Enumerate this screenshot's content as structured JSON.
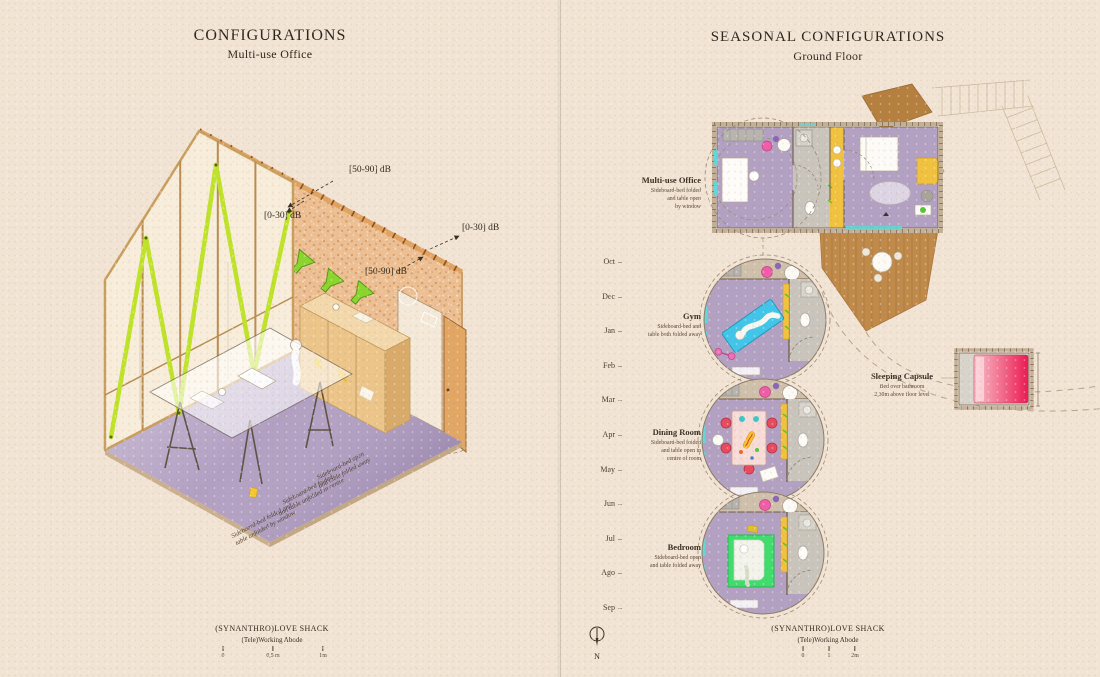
{
  "left_panel": {
    "title": "CONFIGURATIONS",
    "subtitle": "Multi-use Office",
    "db_labels": {
      "roof": "[50-90] dB",
      "glazing": "[0-30] dB",
      "door": "[0-30] dB",
      "wall": "[50-90] dB"
    },
    "floor_notes": [
      "Sideboard-bed open\nand table folded away",
      "Sideboard-bed folded\nand table unfolded in centre",
      "Sideboard-bed folded and\ntable unfolded by window"
    ],
    "footer": {
      "project": "(SYNANTHRO)LOVE SHACK",
      "series": "(Tele)Working Abode"
    },
    "scale_ticks": [
      "0",
      "0,5 m",
      "1m"
    ]
  },
  "right_panel": {
    "title": "SEASONAL CONFIGURATIONS",
    "subtitle": "Ground Floor",
    "months": [
      "Oct",
      "Dec",
      "Jan",
      "Feb",
      "Mar",
      "Apr",
      "May",
      "Jun",
      "Jul",
      "Ago",
      "Sep"
    ],
    "configurations": [
      {
        "name": "Multi-use Office",
        "description": "Sideboard-bed folded\nand table open\nby window"
      },
      {
        "name": "Gym",
        "description": "Sideboard-bed and\ntable both folded away"
      },
      {
        "name": "Dining Room",
        "description": "Sideboard-bed folded\nand table open in\ncentre of room"
      },
      {
        "name": "Bedroom",
        "description": "Sideboard-bed open\nand table folded away"
      }
    ],
    "sleeping_capsule": {
      "name": "Sleeping Capsule",
      "description": "Bed over bathroom\n2,30m above floor level"
    },
    "compass_label": "N",
    "footer": {
      "project": "(SYNANTHRO)LOVE SHACK",
      "series": "(Tele)Working Abode"
    },
    "scale_ticks": [
      "0",
      "1",
      "2m"
    ]
  },
  "colors": {
    "paper": "#f2e4d4",
    "cork": "#ecc094",
    "timber": "#dfa05f",
    "floor_purple": "#b2a0c3",
    "brace_green": "#bfe32a",
    "deck_brown": "#c08a4b",
    "mat_cyan": "#41c6e9",
    "bed_green": "#40dd6d",
    "capsule_pink": "#ec1a52",
    "kitchen_yellow": "#f0c23f",
    "ink": "#3a2f24"
  }
}
